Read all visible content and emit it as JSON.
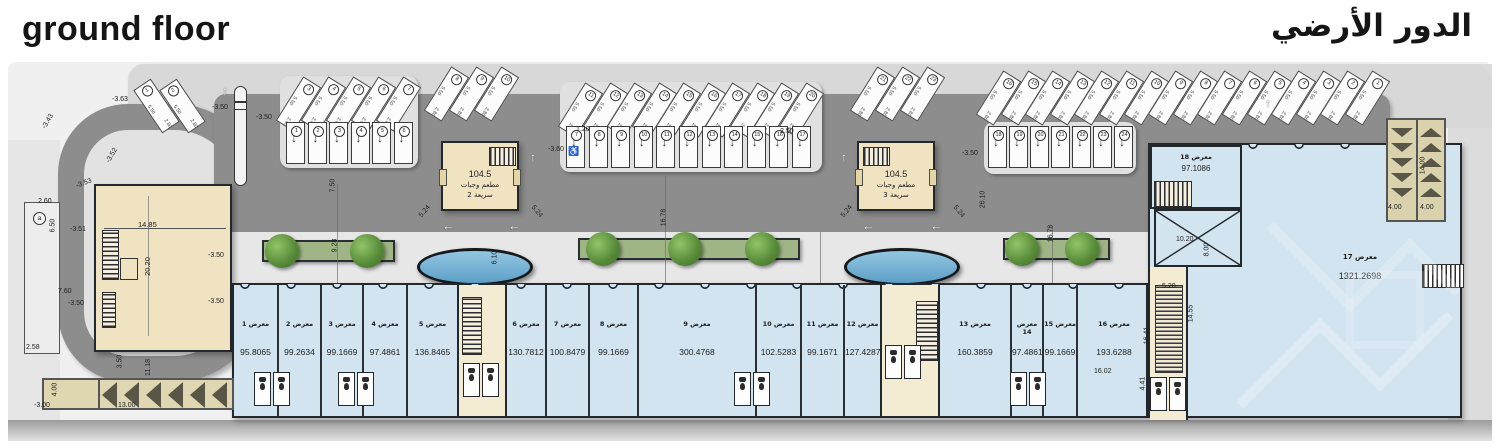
{
  "titles": {
    "en": "ground floor",
    "ar": "الدور الأرضي"
  },
  "units": [
    {
      "label": "معرض 1",
      "area": "95.8065"
    },
    {
      "label": "معرض 2",
      "area": "99.2634"
    },
    {
      "label": "معرض 3",
      "area": "99.1669"
    },
    {
      "label": "معرض 4",
      "area": "97.4861"
    },
    {
      "label": "معرض 5",
      "area": "136.8465"
    },
    {
      "label": "معرض 6",
      "area": "130.7812"
    },
    {
      "label": "معرض 7",
      "area": "100.8479"
    },
    {
      "label": "معرض 8",
      "area": "99.1669"
    },
    {
      "label": "معرض 9",
      "area": "300.4768"
    },
    {
      "label": "معرض 10",
      "area": "102.5283"
    },
    {
      "label": "معرض 11",
      "area": "99.1671"
    },
    {
      "label": "معرض 12",
      "area": "127.4287"
    },
    {
      "label": "معرض 13",
      "area": "160.3859"
    },
    {
      "label": "معرض 14",
      "area": "97.4861"
    },
    {
      "label": "معرض 15",
      "area": "99.1669"
    },
    {
      "label": "معرض 16",
      "area": "193.6288"
    },
    {
      "label": "معرض 17",
      "area": "1321.2698"
    },
    {
      "label": "معرض 18",
      "area": "97.1086"
    }
  ],
  "restaurants": [
    {
      "area": "104.5",
      "line1": "مطعم وجبات",
      "line2": "سريعة 2"
    },
    {
      "area": "104.5",
      "line1": "مطعم وجبات",
      "line2": "سريعة 3"
    }
  ],
  "parking": {
    "stall_depth": "5.50",
    "stall_width": "2.80",
    "groups": {
      "left_pair": [
        "1",
        "2"
      ],
      "island_c_angled": [
        "3",
        "4",
        "5",
        "6",
        "7"
      ],
      "island_c_perp": [
        "1",
        "2",
        "3",
        "4",
        "5",
        "6"
      ],
      "above_r2": [
        "8",
        "9",
        "10"
      ],
      "island_a_angled": [
        "11",
        "12",
        "13",
        "14",
        "15",
        "16",
        "17",
        "18",
        "19",
        "20"
      ],
      "island_a_perp": [
        "7",
        "8",
        "9",
        "10",
        "11",
        "12",
        "13",
        "14",
        "15",
        "16",
        "17"
      ],
      "above_r3": [
        "21",
        "22",
        "23"
      ],
      "island_b_perp": [
        "18",
        "19",
        "20",
        "21",
        "22",
        "23",
        "24"
      ],
      "run_right": [
        "16",
        "15",
        "14",
        "13",
        "12",
        "11",
        "10",
        "9",
        "8",
        "7",
        "6",
        "5",
        "4",
        "3",
        "2",
        "1"
      ]
    }
  },
  "dims": [
    "-3.63",
    "-3.43",
    "-3.52",
    "-3.53",
    "-3.51",
    "2.60",
    "6.50",
    "7.60",
    "-3.50",
    "-3.50",
    "-3.50",
    "2.58",
    "-3.00",
    "4.00",
    "13.00",
    "11.18",
    "3.50",
    "14.85",
    "20.20",
    "-3.50",
    "-3.50",
    "7.50",
    "-3.60",
    "-3.50",
    "26.10",
    "16.78",
    "16.78",
    "9.28",
    "6.10",
    "5.24",
    "5.24",
    "5.24",
    "5.24",
    "1.20",
    "2.50",
    "10.20",
    "8.00",
    "5.20",
    "14.55",
    "16.41",
    "4.41",
    "16.02",
    "4.00",
    "4.00",
    "14.00"
  ],
  "marker_a": "a",
  "icons": {
    "arrow_up": "↑",
    "arrow_left": "←",
    "arrow_down": "↓",
    "wheelchair": "♿"
  },
  "colors": {
    "road": "#8d8d8d",
    "retail_fill": "#d2e4f0",
    "building_fill": "#f0e3c2",
    "pool": "#5d9fc7",
    "planter": "#9fb585",
    "wall": "#23282d"
  }
}
